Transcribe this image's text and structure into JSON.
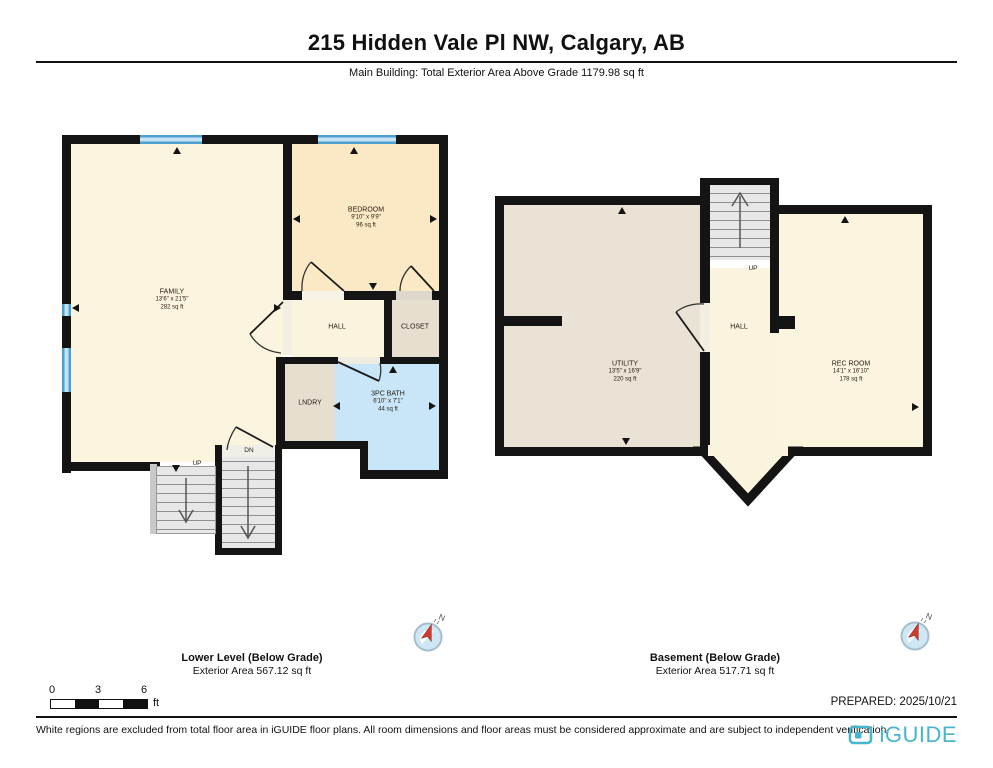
{
  "header": {
    "title": "215 Hidden Vale Pl NW, Calgary, AB",
    "subtitle": "Main Building: Total Exterior Area Above Grade 1179.98 sq ft"
  },
  "lower": {
    "label": "Lower Level (Below Grade)",
    "area_label": "Exterior Area 567.12 sq ft",
    "rooms": {
      "family": {
        "name": "FAMILY",
        "dims": "13'6\" x 21'5\"",
        "area": "282 sq ft"
      },
      "bedroom": {
        "name": "BEDROOM",
        "dims": "9'10\" x 9'9\"",
        "area": "96 sq ft"
      },
      "hall": {
        "name": "HALL"
      },
      "closet": {
        "name": "CLOSET"
      },
      "lndry": {
        "name": "LNDRY"
      },
      "bath": {
        "name": "3PC BATH",
        "dims": "6'10\" x 7'1\"",
        "area": "44 sq ft"
      },
      "up": "UP",
      "dn": "DN"
    }
  },
  "basement": {
    "label": "Basement (Below Grade)",
    "area_label": "Exterior Area 517.71 sq ft",
    "rooms": {
      "utility": {
        "name": "UTILITY",
        "dims": "13'5\" x 16'9\"",
        "area": "220 sq ft"
      },
      "hall": {
        "name": "HALL"
      },
      "rec": {
        "name": "REC ROOM",
        "dims": "14'1\" x 16'10\"",
        "area": "178 sq ft"
      },
      "up": "UP"
    }
  },
  "scale_bar": {
    "start": "0",
    "mid": "3",
    "end": "6",
    "unit": "ft"
  },
  "compass": {
    "north": "N"
  },
  "footer": {
    "disclaimer": "White regions are excluded from total floor area in iGUIDE floor plans. All room dimensions and floor areas must be considered approximate and are subject to independent verification.",
    "prepared": "PREPARED: 2025/10/21",
    "brand": "iGUIDE"
  },
  "colors": {
    "wall": "#141414",
    "window_blue": "#4D9FD0",
    "bath_blue": "#C8E6F7",
    "room_cream": "#FBF5DF",
    "bedroom_peach": "#FBE9C6",
    "closet_tan": "#E6DFD0",
    "utility_tan": "#EAE2D4",
    "stair_gray": "#E7E7E7",
    "brand_teal": "#47B6CC",
    "compass_red": "#D23B2F"
  }
}
